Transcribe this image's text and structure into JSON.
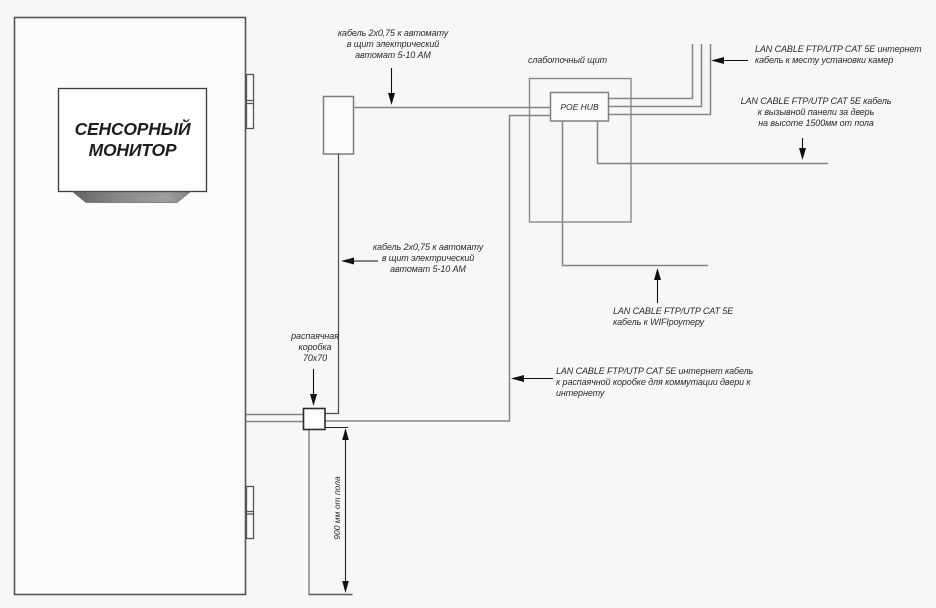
{
  "colors": {
    "background": "#f7f7f5",
    "cable_line": "#858585",
    "structure_line": "#565656",
    "dark_line": "#1d1d1d",
    "text": "#2b2b2b",
    "stand_dark": "#646464",
    "stand_light": "#9e9e9e"
  },
  "labels": {
    "monitor": "СЕНСОРНЫЙ\nМОНИТОР",
    "panel": "слаботочный щит",
    "poe_hub": "POE HUB",
    "power_cable_top": "кабель 2х0,75 к автомату\nв щит электрический\nавтомат  5-10 АМ",
    "power_cable_mid": "кабель 2х0,75 к автомату\nв щит электрический\nавтомат  5-10 АМ",
    "lan_cameras": "LAN CABLE FTP/UTP CAT 5E интернет\nкабель к месту установки камер",
    "lan_door_panel": "LAN CABLE FTP/UTP CAT 5E кабель\nк вызывной панели за дверь\nна высоте 1500мм от пола",
    "lan_wifi": "LAN CABLE FTP/UTP CAT 5E\nкабель к WIFIроутеру",
    "lan_junction": "LAN CABLE FTP/UTP CAT 5E  интернет кабель\nк распаячной коробке для коммутации двери к интернету",
    "junction_box": "распаячная\nкоробка\n70х70",
    "dimension_height": "900 мм от пола"
  }
}
